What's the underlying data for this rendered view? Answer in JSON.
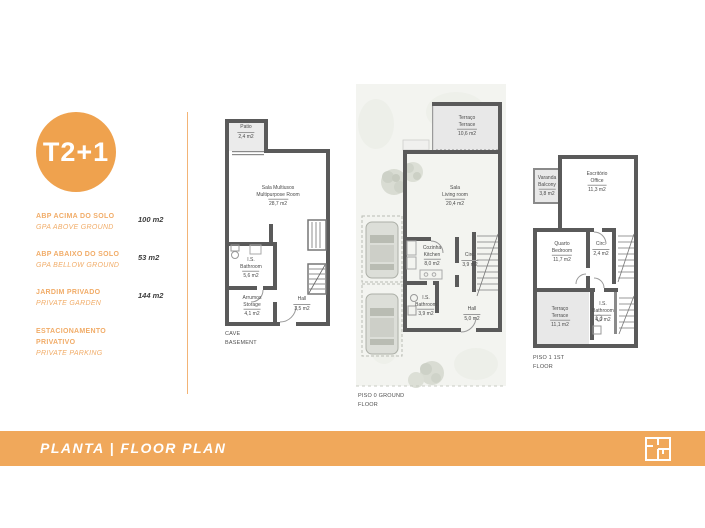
{
  "colors": {
    "accent_orange": "#EFA24E",
    "bar_orange": "#F0A85B",
    "label_orange": "#F1AC68",
    "wall_gray": "#5A5A5A",
    "room_fill_gray": "#E8E8E8",
    "value_gray": "#3E3E3E"
  },
  "sidebar": {
    "badge_label": "T2+1",
    "specs": [
      {
        "lines": [
          "ABP ACIMA DO SOLO"
        ],
        "sub": "GPA ABOVE GROUND",
        "value": "100 m2"
      },
      {
        "lines": [
          "ABP ABAIXO DO SOLO"
        ],
        "sub": "GPA BELLOW GROUND",
        "value": "53 m2"
      },
      {
        "lines": [
          "JARDIM PRIVADO"
        ],
        "sub": "PRIVATE GARDEN",
        "value": "144 m2"
      },
      {
        "lines": [
          "ESTACIONAMENTO",
          "PRIVATIVO"
        ],
        "sub": "PRIVATE PARKING",
        "value": ""
      }
    ]
  },
  "plans": [
    {
      "floor_lines": [
        "CAVE",
        "BASEMENT"
      ],
      "rooms": [
        {
          "lines": [
            "Patio"
          ],
          "area": "2,4 m2"
        },
        {
          "lines": [
            "Sala Multiusos",
            "Multipurpose Room"
          ],
          "area": "28,7 m2"
        },
        {
          "lines": [
            "I.S.",
            "Bathroom"
          ],
          "area": "5,6 m2"
        },
        {
          "lines": [
            "Arrumos",
            "Storage"
          ],
          "area": "4,1 m2"
        },
        {
          "lines": [
            "Hall"
          ],
          "area": "3,5 m2"
        }
      ]
    },
    {
      "floor_lines": [
        "PISO 0 GROUND",
        "FLOOR"
      ],
      "rooms": [
        {
          "lines": [
            "Terraço",
            "Terrace"
          ],
          "area": "10,6 m2"
        },
        {
          "lines": [
            "Sala",
            "Living room"
          ],
          "area": "20,4 m2"
        },
        {
          "lines": [
            "Cozinha",
            "Kitchen"
          ],
          "area": "8,0 m2"
        },
        {
          "lines": [
            "Circ."
          ],
          "area": "3,9 m2"
        },
        {
          "lines": [
            "I.S.",
            "Bathroom"
          ],
          "area": "3,9 m2"
        },
        {
          "lines": [
            "Hall"
          ],
          "area": "5,0 m2"
        }
      ]
    },
    {
      "floor_lines": [
        "PISO 1 1ST",
        "FLOOR"
      ],
      "rooms": [
        {
          "lines": [
            "Varanda",
            "Balcony"
          ],
          "area": "3,8 m2"
        },
        {
          "lines": [
            "Escritório",
            "Office"
          ],
          "area": "11,3 m2"
        },
        {
          "lines": [
            "Quarto",
            "Bedroom"
          ],
          "area": "11,7 m2"
        },
        {
          "lines": [
            "Circ."
          ],
          "area": "2,4 m2"
        },
        {
          "lines": [
            "Terraço",
            "Terrace"
          ],
          "area": "11,1 m2"
        },
        {
          "lines": [
            "I.S.",
            "Bathroom"
          ],
          "area": "4,0 m2"
        }
      ]
    }
  ],
  "footer": {
    "title": "PLANTA | FLOOR PLAN",
    "icon": "floorplan-icon"
  }
}
